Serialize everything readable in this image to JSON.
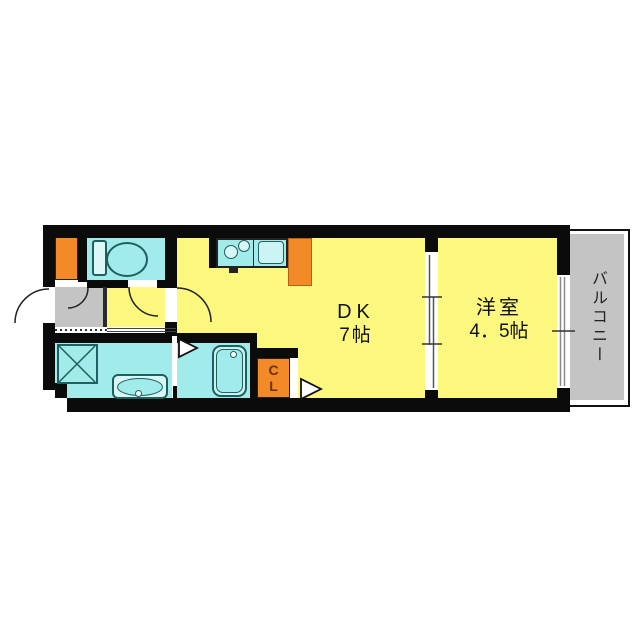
{
  "rooms": {
    "dk": {
      "name": "DK",
      "size": "7帖"
    },
    "western": {
      "name": "洋室",
      "size": "4．5帖"
    },
    "balcony": {
      "name": "バルコニー"
    },
    "closet": {
      "line1": "C",
      "line2": "L"
    }
  },
  "fixtures": {
    "toilet": "toilet-icon",
    "stove": "stove-burners-icon",
    "kitchen_sink": "kitchen-sink-icon",
    "refrigerator": "refrigerator-space",
    "washing_machine_pan": "washing-machine-pan-icon",
    "vanity_basin": "vanity-basin-icon",
    "bathtub": "bathtub-icon",
    "entry_door": "entry-door-swing-icon",
    "interior_doors": "door-swing-arc-icon",
    "sliding_door": "sliding-door-icon",
    "window": "window-icon",
    "door_markers": "door-direction-triangle-icon"
  },
  "colors": {
    "wall": "#0b0b0b",
    "room-yellow": "#fbf77f",
    "wet-cyan": "#a2ebeb",
    "entry-gray": "#c4c4c4",
    "accent-orange": "#f28a28"
  }
}
